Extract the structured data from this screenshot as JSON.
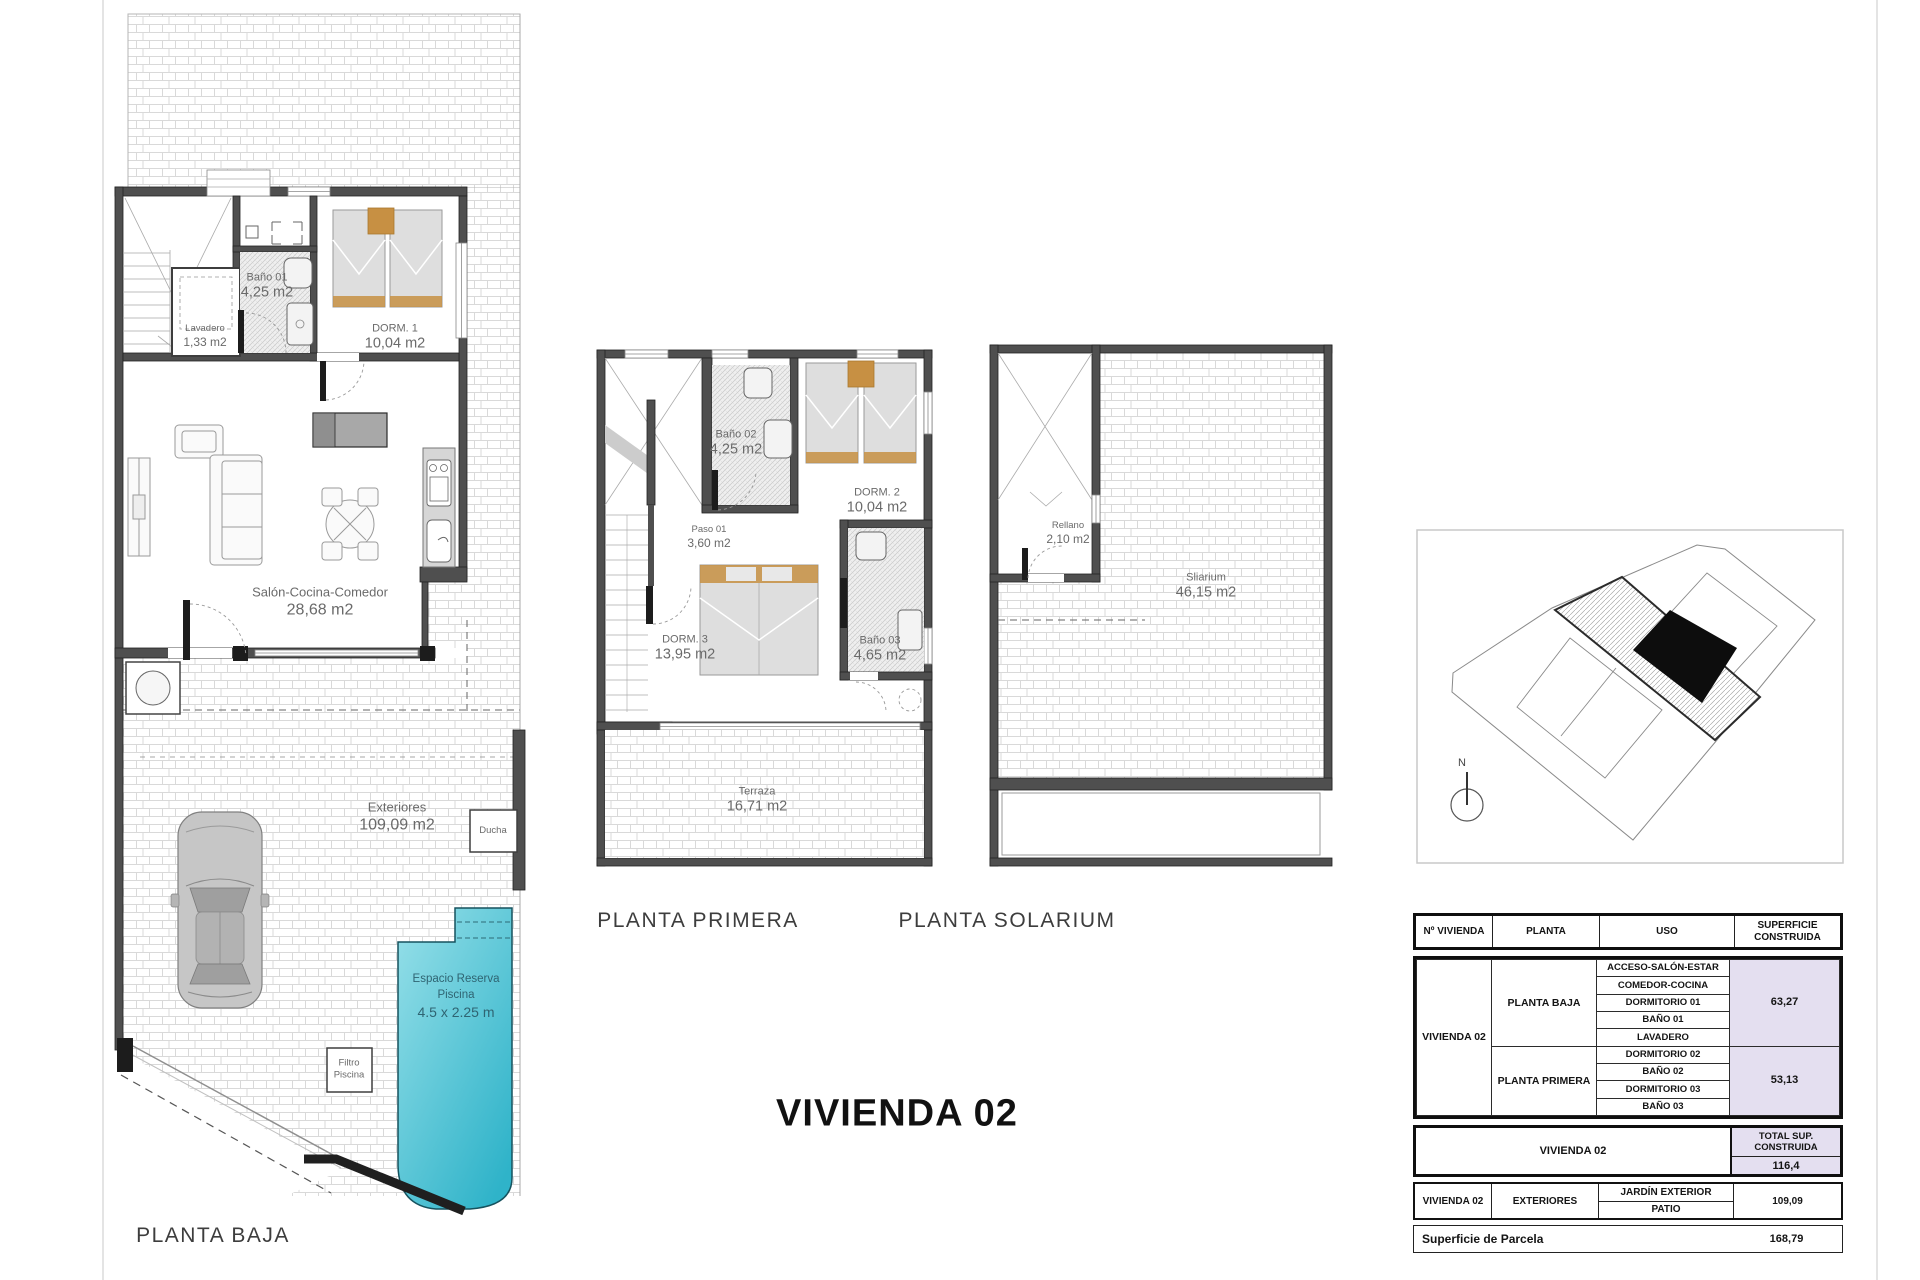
{
  "page": {
    "title": "VIVIENDA 02"
  },
  "plans": {
    "baja": {
      "title": "PLANTA BAJA",
      "bano01_name": "Baño 01",
      "bano01_area": "4,25 m2",
      "lavadero_name": "Lavadero",
      "lavadero_area": "1,33 m2",
      "dorm1_name": "DORM. 1",
      "dorm1_area": "10,04 m2",
      "salon_name": "Salón-Cocina-Comedor",
      "salon_area": "28,68 m2",
      "exteriores_name": "Exteriores",
      "exteriores_area": "109,09 m2",
      "ducha": "Ducha",
      "piscina_l1": "Espacio Reserva",
      "piscina_l2": "Piscina",
      "piscina_l3": "4.5 x 2.25 m",
      "filtro_l1": "Filtro",
      "filtro_l2": "Piscina"
    },
    "primera": {
      "title": "PLANTA PRIMERA",
      "bano02_name": "Baño 02",
      "bano02_area": "4,25 m2",
      "dorm2_name": "DORM. 2",
      "dorm2_area": "10,04 m2",
      "paso_name": "Paso 01",
      "paso_area": "3,60 m2",
      "dorm3_name": "DORM. 3",
      "dorm3_area": "13,95 m2",
      "bano03_name": "Baño 03",
      "bano03_area": "4,65 m2",
      "terraza_name": "Terraza",
      "terraza_area": "16,71 m2"
    },
    "solarium": {
      "title": "PLANTA SOLARIUM",
      "rellano_name": "Rellano",
      "rellano_area": "2,10 m2",
      "solarium_name": "Sliarium",
      "solarium_area": "46,15 m2"
    }
  },
  "map": {
    "north": "N"
  },
  "table": {
    "h_vivienda": "Nº VIVIENDA",
    "h_planta": "PLANTA",
    "h_uso": "USO",
    "h_sup1": "SUPERFICIE",
    "h_sup2": "CONSTRUIDA",
    "vivienda": "VIVIENDA 02",
    "baja_label": "PLANTA BAJA",
    "baja_usos": [
      "ACCESO-SALÓN-ESTAR",
      "COMEDOR-COCINA",
      "DORMITORIO 01",
      "BAÑO 01",
      "LAVADERO"
    ],
    "baja_sup": "63,27",
    "primera_label": "PLANTA PRIMERA",
    "primera_usos": [
      "DORMITORIO 02",
      "BAÑO 02",
      "DORMITORIO 03",
      "BAÑO 03"
    ],
    "primera_sup": "53,13",
    "total_vivienda": "VIVIENDA 02",
    "total_h1": "TOTAL SUP.",
    "total_h2": "CONSTRUIDA",
    "total_value": "116,4",
    "ext_vivienda": "VIVIENDA 02",
    "ext_planta": "EXTERIORES",
    "ext_uso1": "JARDÍN EXTERIOR",
    "ext_uso2": "PATIO",
    "ext_sup": "109,09",
    "parcela_label": "Superficie de Parcela",
    "parcela_value": "168,79"
  },
  "colors": {
    "pool_light": "#97e0e9",
    "pool_dark": "#2fb3c9",
    "shaded_cell": "#e4dff0",
    "wall": "#4f4f4f",
    "pillow": "#c79043"
  }
}
